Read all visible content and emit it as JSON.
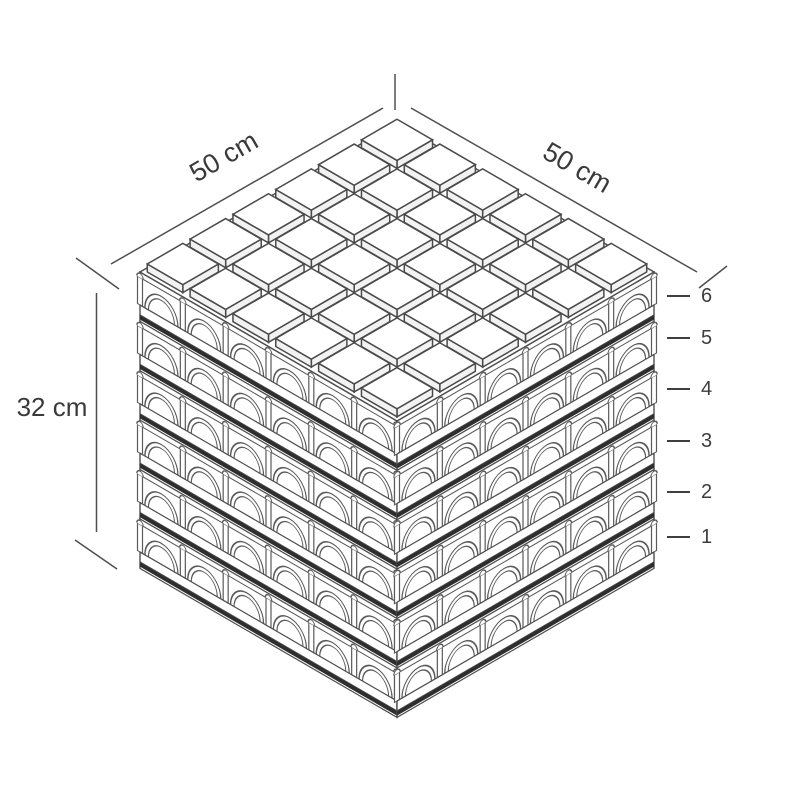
{
  "diagram": {
    "background_color": "#ffffff",
    "line_color": "#4f4f4f",
    "detail_line_color": "#5a5a5a",
    "dark_band_color": "#2e2e2e",
    "text_color": "#3a3a3a",
    "grid_rows": 6,
    "grid_cols": 6,
    "layer_count": 6,
    "dimension_labels": {
      "depth": "50 cm",
      "width": "50 cm",
      "height": "32 cm"
    },
    "layer_numbers": [
      "6",
      "5",
      "4",
      "3",
      "2",
      "1"
    ]
  }
}
